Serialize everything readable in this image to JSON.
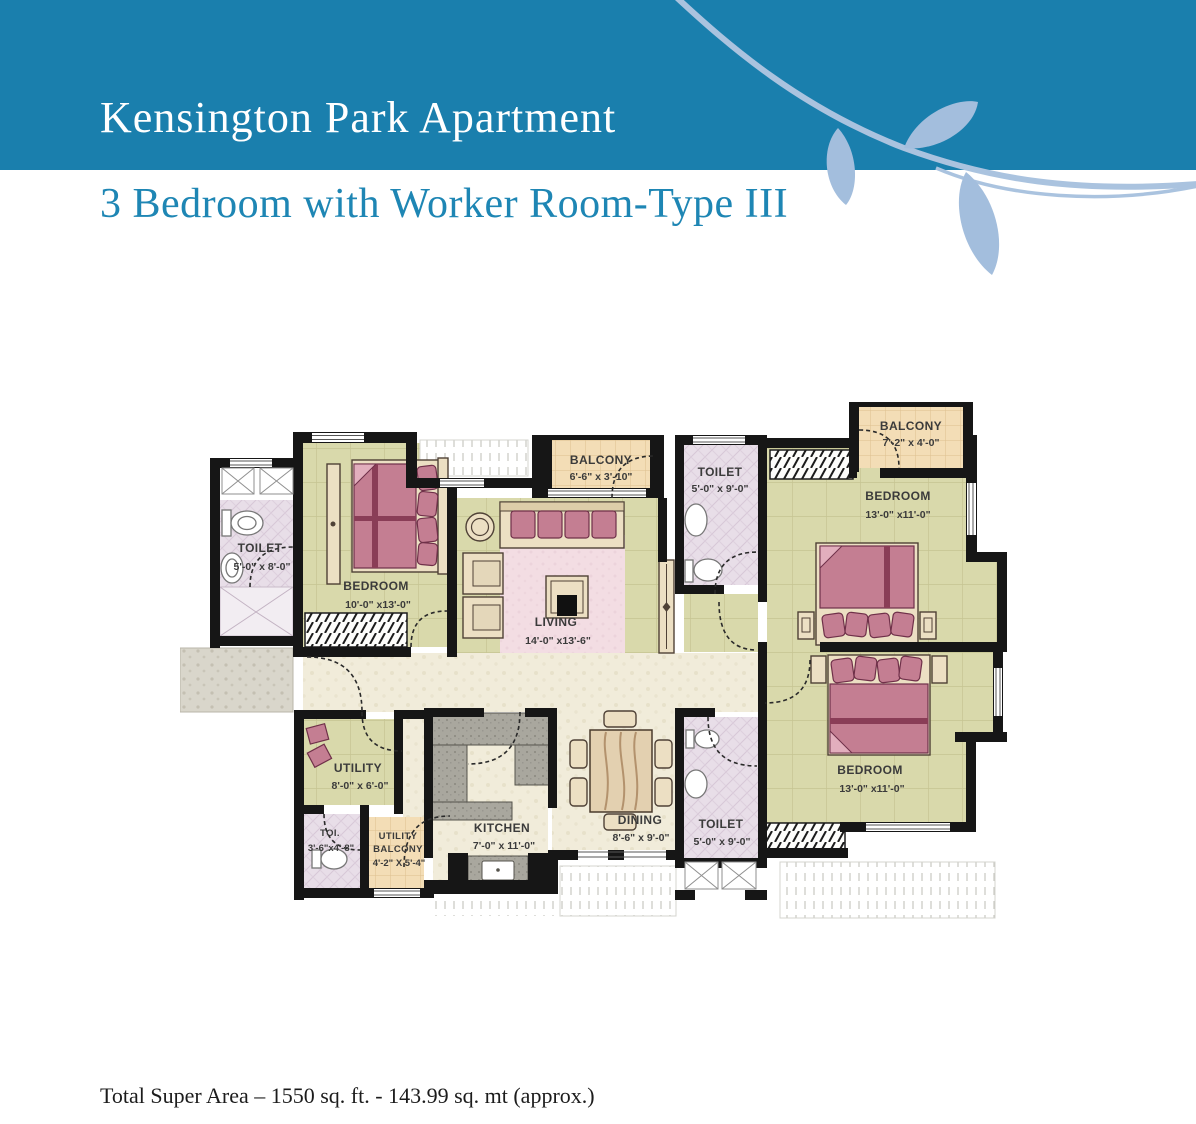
{
  "header": {
    "title": "Kensington Park Apartment",
    "bg_color": "#1a7fad",
    "title_color": "#ffffff"
  },
  "subtitle": {
    "text": "3 Bedroom with Worker Room-Type III",
    "color": "#1e86b4"
  },
  "footer": {
    "total_area": "Total Super Area – 1550 sq. ft. - 143.99 sq. mt (approx.)"
  },
  "decoration": {
    "icon": "leaf-branch",
    "leaf_color": "#a3bedd",
    "swoosh_color": "#aac3df"
  },
  "plan": {
    "palette": {
      "wall": "#161616",
      "bedroom_floor": "#d9d9ab",
      "toilet_floor": "#e8dee8",
      "balcony_floor": "#f3ddb6",
      "living_carpet": "#f3dde3",
      "corridor_floor": "#f1ecda",
      "kitchen_counter": "#a9a79e",
      "furniture_wood": "#ecdfc3",
      "bed_fabric": "#c47e92"
    },
    "rooms": [
      {
        "id": "toilet-1",
        "name": "TOILET",
        "dims": "5'-0\" x 8'-0\""
      },
      {
        "id": "bedroom-1",
        "name": "BEDROOM",
        "dims": "10'-0\" x13'-0\""
      },
      {
        "id": "balcony-1",
        "name": "BALCONY",
        "dims": "6'-6\" x 3'-10\""
      },
      {
        "id": "toilet-2",
        "name": "TOILET",
        "dims": "5'-0\" x 9'-0\""
      },
      {
        "id": "bedroom-2",
        "name": "BEDROOM",
        "dims": "13'-0\" x11'-0\""
      },
      {
        "id": "balcony-2",
        "name": "BALCONY",
        "dims": "7'-2\" x 4'-0\""
      },
      {
        "id": "living",
        "name": "LIVING",
        "dims": "14'-0\" x13'-6\""
      },
      {
        "id": "utility",
        "name": "UTILITY",
        "dims": "8'-0\" x 6'-0\""
      },
      {
        "id": "toi",
        "name": "TOI.",
        "dims": "3'-6\"x4'-8\""
      },
      {
        "id": "utility-balcony",
        "name": "UTILITY",
        "name2": "BALCONY",
        "dims": "4'-2\" X 5'-4\""
      },
      {
        "id": "kitchen",
        "name": "KITCHEN",
        "dims": "7'-0\" x 11'-0\""
      },
      {
        "id": "dining",
        "name": "DINING",
        "dims": "8'-6\" x 9'-0\""
      },
      {
        "id": "toilet-3",
        "name": "TOILET",
        "dims": "5'-0\" x 9'-0\""
      },
      {
        "id": "bedroom-3",
        "name": "BEDROOM",
        "dims": "13'-0\" x11'-0\""
      }
    ]
  }
}
